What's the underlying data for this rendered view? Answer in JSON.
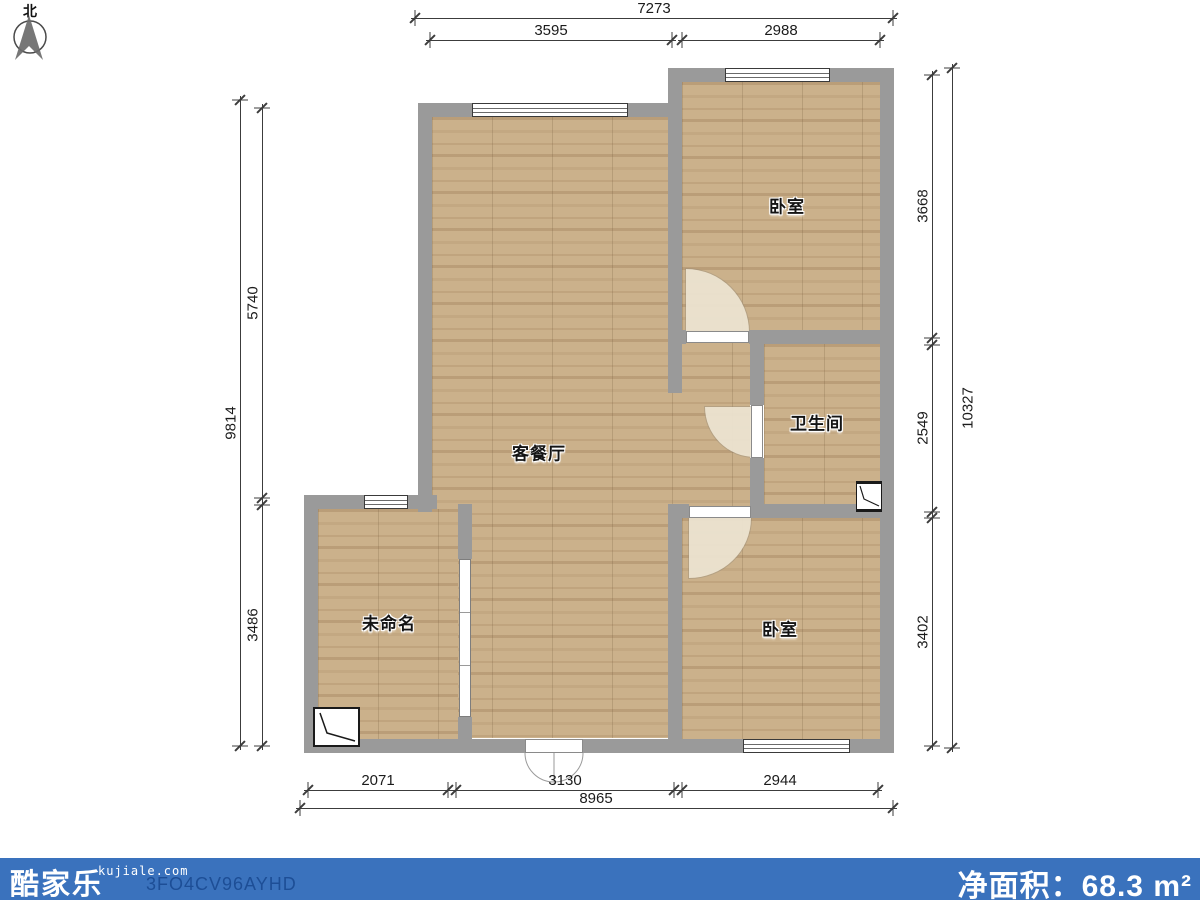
{
  "north": {
    "label": "北"
  },
  "rooms": {
    "bedroom_top": {
      "label": "卧室"
    },
    "bathroom": {
      "label": "卫生间"
    },
    "living": {
      "label": "客餐厅"
    },
    "unnamed": {
      "label": "未命名"
    },
    "bedroom_bottom": {
      "label": "卧室"
    }
  },
  "dims": {
    "top": {
      "total": "7273",
      "s1": "3595",
      "s2": "2988"
    },
    "left": {
      "total": "9814",
      "s1": "5740",
      "s2": "3486"
    },
    "right": {
      "total": "10327",
      "s1": "3668",
      "s2": "2549",
      "s3": "3402"
    },
    "bottom": {
      "total": "8965",
      "s1": "2071",
      "s2": "3130",
      "s3": "2944"
    }
  },
  "footer": {
    "logo": "酷家乐",
    "site": "kujiale.com",
    "code": "3FO4CV96AYHD",
    "area_label": "净面积：",
    "area_value": "68.3",
    "area_unit": "m²"
  },
  "colors": {
    "wall": "#9a9a9a",
    "floor": "#cbb18b",
    "footer_bar": "#3a72bd",
    "code_text": "#1d4e96"
  }
}
